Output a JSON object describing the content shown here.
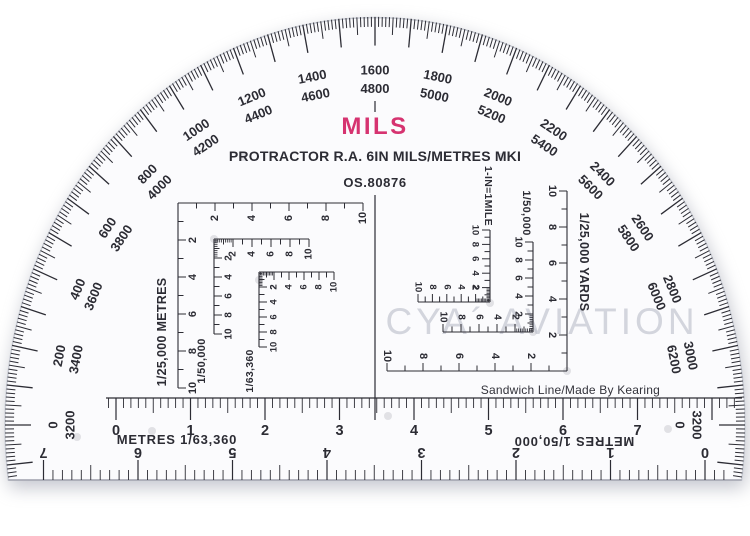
{
  "header": {
    "mils": "MILS",
    "title": "PROTRACTOR R.A. 6IN MILS/METRES MKI",
    "ref": "OS.80876"
  },
  "watermark": "CYA´ AVIATION",
  "credit": "Sandwich Line/Made By Kearing",
  "arc_labels": [
    {
      "mils": "0",
      "alt": "3200"
    },
    {
      "mils": "200",
      "alt": "3400"
    },
    {
      "mils": "400",
      "alt": "3600"
    },
    {
      "mils": "600",
      "alt": "3800"
    },
    {
      "mils": "800",
      "alt": "4000"
    },
    {
      "mils": "1000",
      "alt": "4200"
    },
    {
      "mils": "1200",
      "alt": "4400"
    },
    {
      "mils": "1400",
      "alt": "4600"
    },
    {
      "mils": "1600",
      "alt": "4800"
    },
    {
      "mils": "1800",
      "alt": "5000"
    },
    {
      "mils": "2000",
      "alt": "5200"
    },
    {
      "mils": "2200",
      "alt": "5400"
    },
    {
      "mils": "2400",
      "alt": "5600"
    },
    {
      "mils": "2600",
      "alt": "5800"
    },
    {
      "mils": "2800",
      "alt": "6000"
    },
    {
      "mils": "3000",
      "alt": "6200"
    },
    {
      "mils": "3200",
      "alt": "0"
    }
  ],
  "scales": {
    "left": [
      {
        "id": "a",
        "label": "1/25,000 METRES",
        "numbers": [
          "2",
          "4",
          "6",
          "8",
          "10"
        ]
      },
      {
        "id": "b",
        "label": "1/50,000",
        "numbers": [
          "2",
          "4",
          "6",
          "8",
          "10"
        ]
      },
      {
        "id": "c",
        "label": "1/63,360",
        "numbers": [
          "2",
          "4",
          "6",
          "8",
          "10"
        ]
      }
    ],
    "right": [
      {
        "id": "d",
        "label": "1/25,000 YARDS",
        "numbers": [
          "2",
          "4",
          "6",
          "8",
          "10"
        ]
      },
      {
        "id": "e",
        "label": "1/50,000",
        "numbers": [
          "2",
          "4",
          "6",
          "8",
          "10"
        ]
      },
      {
        "id": "f",
        "label": "1-IN=1MILE",
        "numbers": [
          "2",
          "4",
          "6",
          "8",
          "10"
        ]
      }
    ]
  },
  "rulers": {
    "top": {
      "caption": "METRES 1/63,360",
      "numbers": [
        "0",
        "1",
        "2",
        "3",
        "4",
        "5",
        "6",
        "7"
      ]
    },
    "bottom": {
      "caption": "METRES 1/50,000",
      "numbers": [
        "0",
        "1",
        "2",
        "3",
        "4",
        "5",
        "6",
        "7"
      ]
    }
  },
  "colors": {
    "ink": "#2c2c34",
    "accent_pink": "#d63370",
    "watermark_gray": "#b3b7c3",
    "plastic": "#fbfbfd",
    "edge": "#c9ccd4"
  }
}
